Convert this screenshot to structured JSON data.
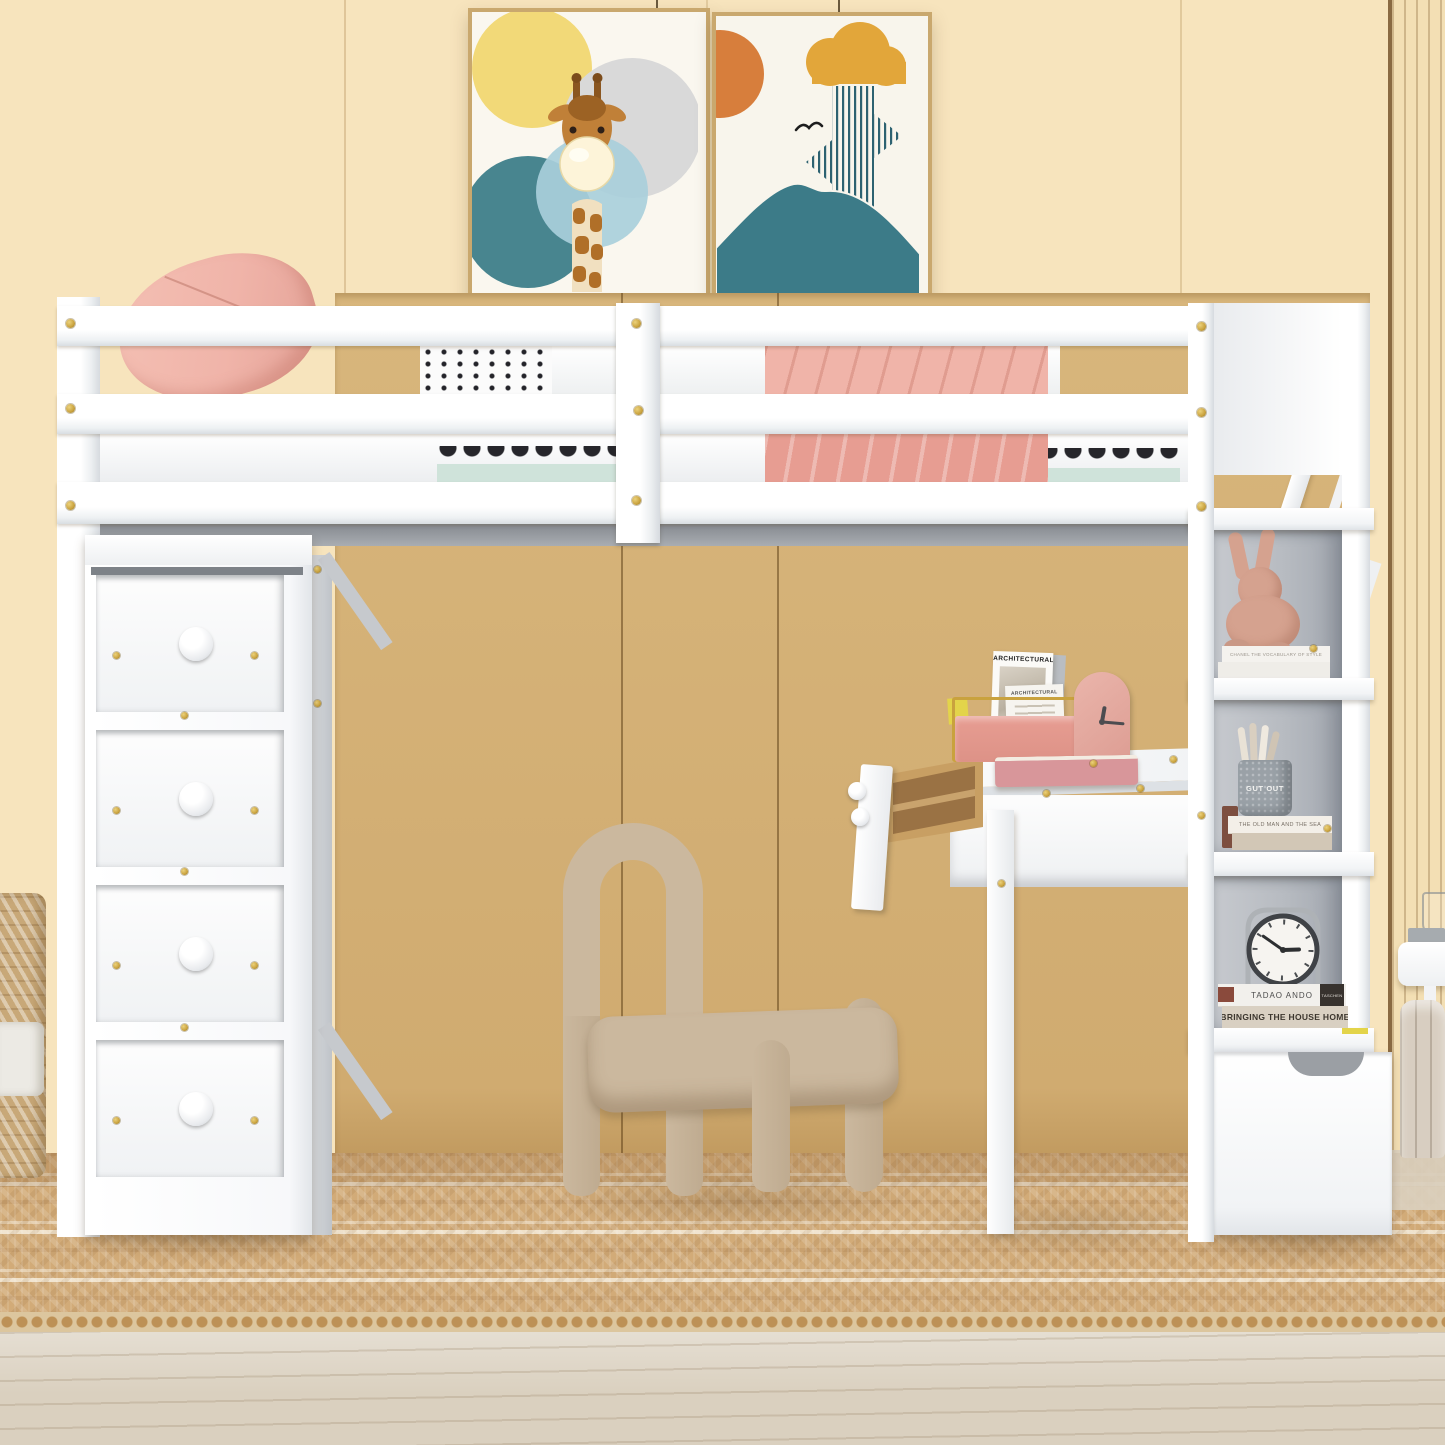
{
  "scene": {
    "description": "Kids bedroom: white twin loft bed with guard rails, four-drawer chest, desk with pulled-out drawer, arch chair, storage staircase shelves, jute rug and two art posters on a cream wall"
  },
  "texts": {
    "chanel_book": "CHANEL THE VOCABULARY OF STYLE",
    "pen_cup": "GUT OUT",
    "old_man_sea": "THE OLD MAN AND THE SEA",
    "tadao_ando": "TADAO ANDO",
    "taschen": "TASCHEN",
    "bringing_home": "BRINGING THE HOUSE HOME",
    "architectural": "ARCHITECTURAL",
    "architectural_small": "ARCHITECTURAL"
  },
  "css": {
    "wall": "#f7e4bd",
    "wall-seam": "#caa36b",
    "wardrobe": "#d8b67c",
    "wardrobe-seam": "#7a5526",
    "slat-groove": "#a87c48",
    "gray-back": "#b7bbc1",
    "gold": "#c9a23e",
    "pink": "#f0b4a9",
    "pink-deep": "#e79d92",
    "chair": "#cbb89e",
    "chair-dark": "#bfab90",
    "rug": "#d2ab78",
    "rug-light": "#f1e6cf",
    "floor": "#dad0bf",
    "mint": "#cfe3da",
    "teal": "#48858f",
    "poster-yellow": "#f2d978",
    "poster-orange": "#d77e3c",
    "poster-mustard": "#e2a63a",
    "poster-gray": "#d9d9d9",
    "poster-blue": "#a9cfdb",
    "stripe-teal": "#2d6271",
    "mountain": "#3c7b88",
    "wood": "#c89f63",
    "wood-dark": "#9a7244",
    "clock-dark": "#3f4246",
    "sticker": "#e3d44a",
    "basket": "#c8a878",
    "pouf": "#d8cec1",
    "frame": "#c9a86e",
    "bunny": "#d5a28f",
    "shelf-hour": "88deg",
    "shelf-min": "305deg",
    "desk-hour": "10deg",
    "desk-min": "95deg"
  }
}
